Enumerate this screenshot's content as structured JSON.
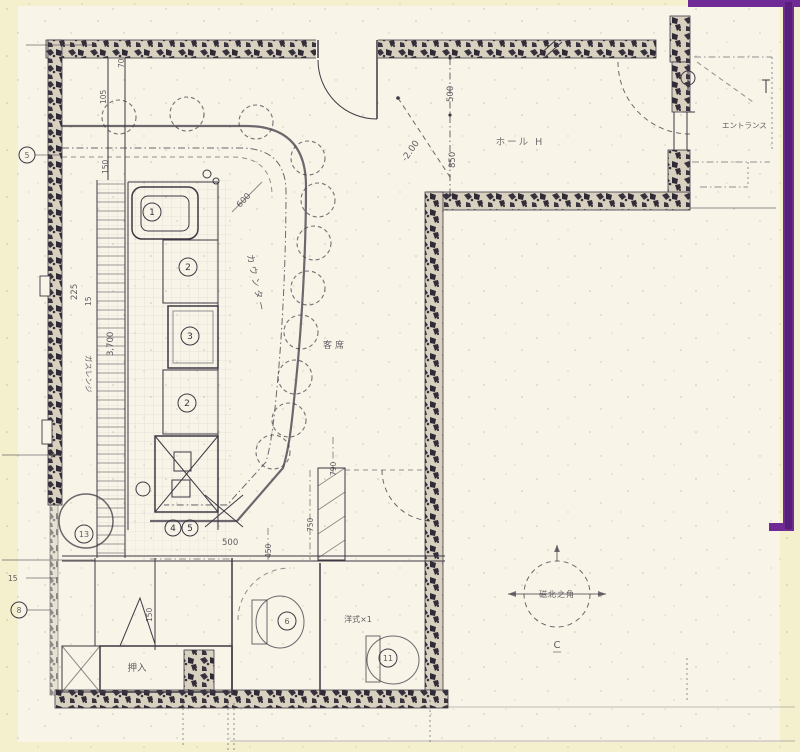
{
  "colors": {
    "background": "#f4efcd",
    "paper": "#f8f5e8",
    "ink": "#3e3844",
    "wall": "#38323e",
    "frame_purple": "#6f2a96"
  },
  "labels": {
    "hall": "ホール H",
    "entrance": "エントランス",
    "counter": "カウンター",
    "seating": "客席",
    "closet": "押入",
    "toilet_type": "洋式×1",
    "gas_stand": "ガスレンジ",
    "compass_center": "磁北之角",
    "compass_c": "C"
  },
  "equipment": {
    "sink": "1",
    "unit2": "2",
    "unit3": "3",
    "unit4": "2",
    "pair_a": "4",
    "pair_b": "5",
    "round_unit": "13",
    "toilet_left": "6",
    "toilet_right": "11"
  },
  "axis_marks": {
    "left_top": "5",
    "left_mid": "15",
    "left_bottom": "8"
  },
  "dims": {
    "w70": "70",
    "w105": "105",
    "w150": "150",
    "w225": "225",
    "w15": "15",
    "h3700": "3,700",
    "c600": "600",
    "level": "-2.00",
    "r500": "500",
    "r850": "850",
    "k500": "500",
    "k450": "450",
    "k750": "750",
    "k790": "790",
    "b150": "150"
  }
}
